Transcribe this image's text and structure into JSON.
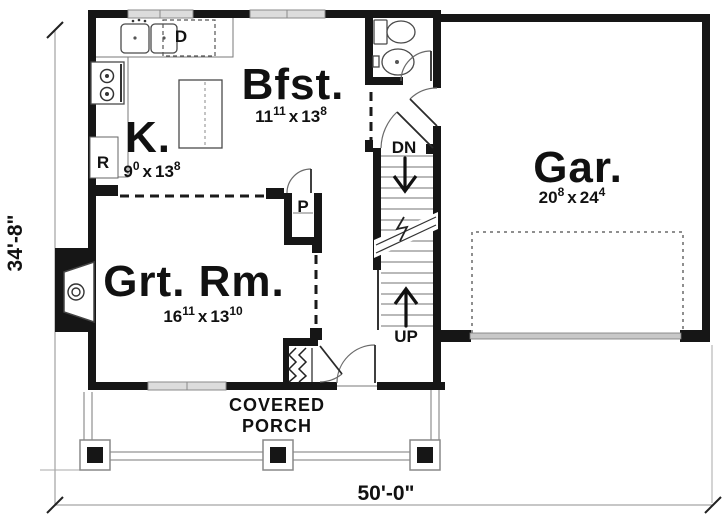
{
  "plan": {
    "rooms": {
      "kitchen": {
        "label": "K.",
        "dim": {
          "w": "9",
          "w_sup": "0",
          "sep": "x",
          "h": "13",
          "h_sup": "8"
        }
      },
      "breakfast": {
        "label": "Bfst.",
        "dim": {
          "w": "11",
          "w_sup": "11",
          "sep": "x",
          "h": "13",
          "h_sup": "8"
        }
      },
      "great_room": {
        "label": "Grt. Rm.",
        "dim": {
          "w": "16",
          "w_sup": "11",
          "sep": "x",
          "h": "13",
          "h_sup": "10"
        }
      },
      "garage": {
        "label": "Gar.",
        "dim": {
          "w": "20",
          "w_sup": "8",
          "sep": "x",
          "h": "24",
          "h_sup": "4"
        }
      }
    },
    "appliances": {
      "dishwasher": "D",
      "refrigerator": "R",
      "pantry": "P"
    },
    "stairs": {
      "down": "DN",
      "up": "UP"
    },
    "porch": {
      "line1": "COVERED",
      "line2": "PORCH"
    },
    "dimensions": {
      "width": "50'-0\"",
      "depth": "34'-8\""
    },
    "colors": {
      "wall": "#161616",
      "window": "#dcdcdc",
      "garage_door": "#c8c8c8"
    }
  }
}
